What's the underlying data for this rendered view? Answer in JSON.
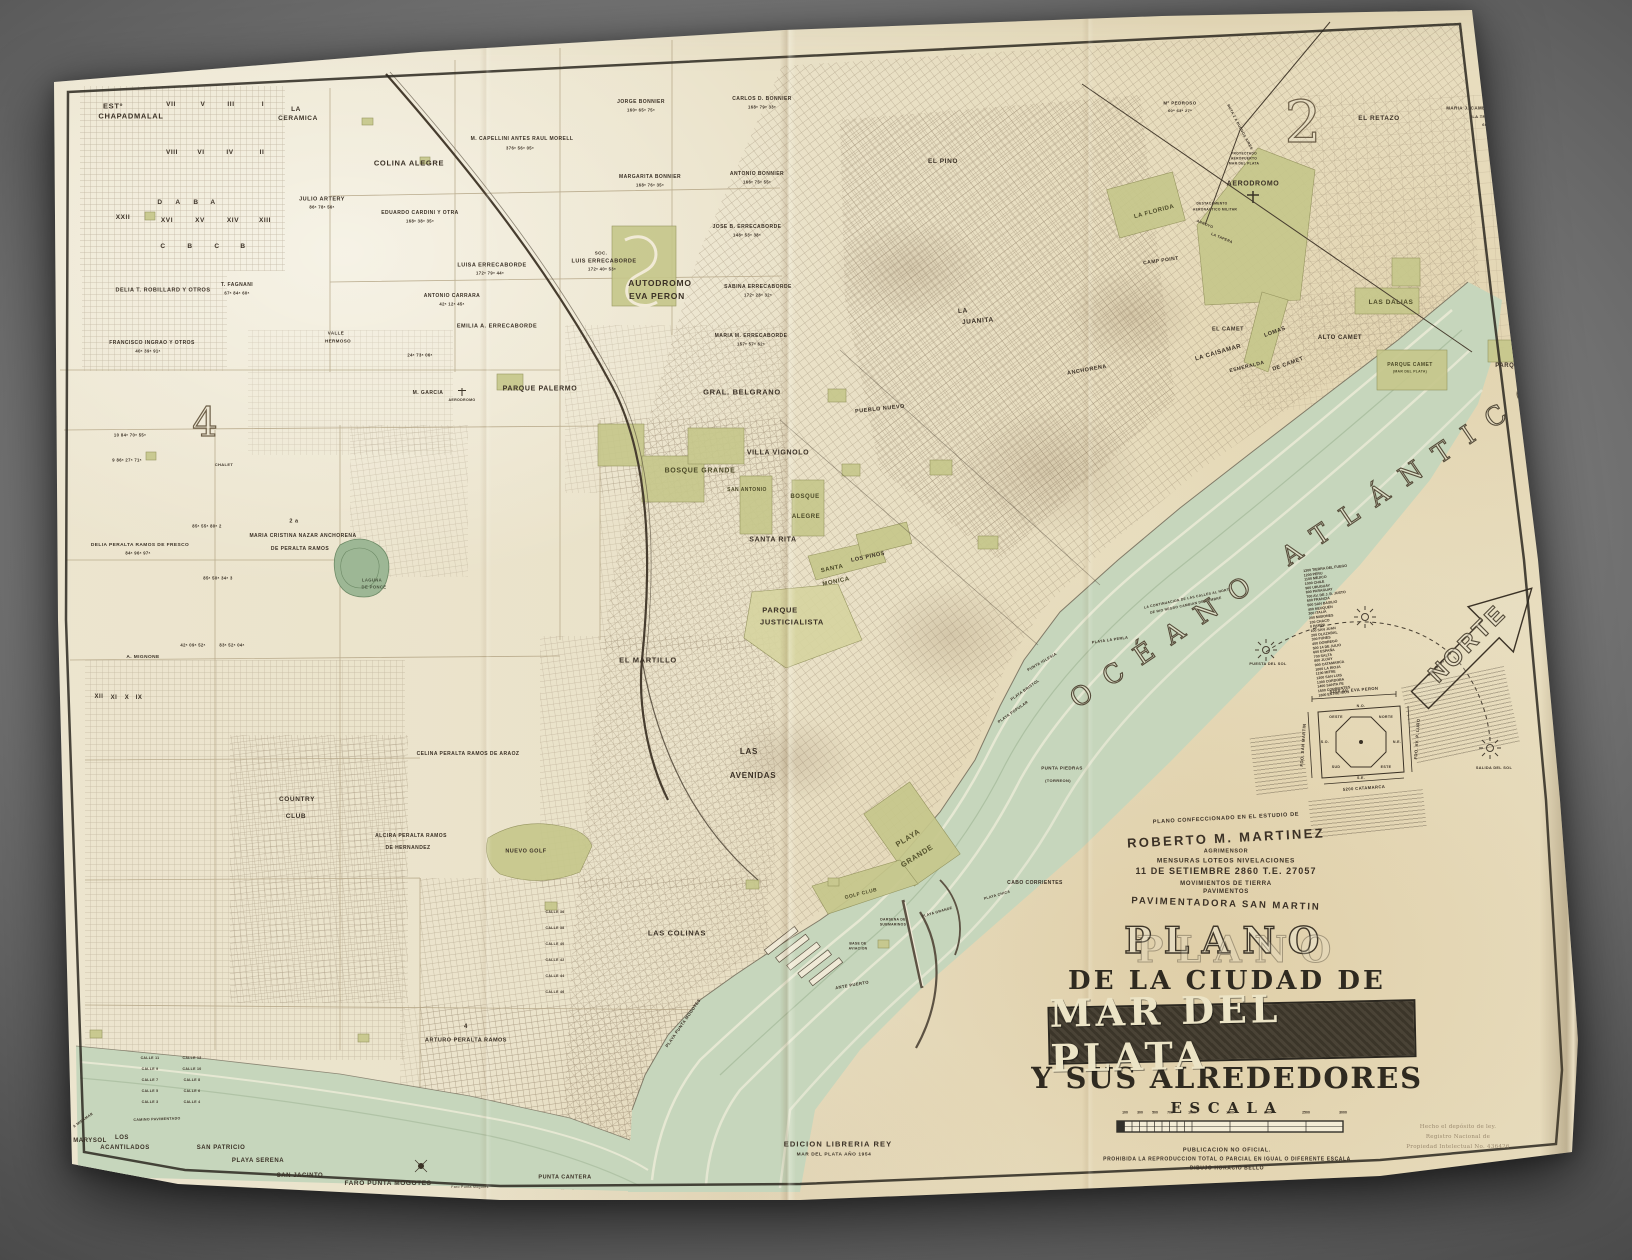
{
  "ocean": {
    "label": "OCÉANO ATLÁNTICO"
  },
  "north": {
    "label": "NORTE"
  },
  "title_block": {
    "attribution": [
      "PLANO CONFECCIONADO EN EL ESTUDIO DE",
      "ROBERTO M. MARTINEZ",
      "AGRIMENSOR",
      "MENSURAS LOTEOS NIVELACIONES",
      "11 DE SETIEMBRE 2860   T.E. 27057",
      "MOVIMIENTOS DE TIERRA",
      "PAVIMENTOS",
      "PAVIMENTADORA  SAN MARTIN"
    ],
    "title_word": "PLANO",
    "subtitle": "DE LA CIUDAD DE",
    "city": "MAR DEL PLATA",
    "subtitle2": "Y SUS ALREDEDORES",
    "scale_label": "ESCALA",
    "publication": [
      "PUBLICACION NO OFICIAL.",
      "PROHIBIDA LA REPRODUCCION TOTAL O PARCIAL EN IGUAL O DIFERENTE ESCALA",
      "DIBUJO HORACIO BELLO"
    ],
    "edition": [
      "EDICION LIBRERIA REY",
      "MAR DEL PLATA AÑO 1954"
    ],
    "deposit": [
      "Hecho el depósito de ley.",
      "Registro Nacional de",
      "Propiedad Intelectual No. 436426"
    ]
  },
  "compass": {
    "top": "5200 AV. EVA PERON",
    "bottom": "5200 CATAMARCA",
    "left": "FDO. SAN MARTIN",
    "right": "FDO. AV. P. LURO",
    "dirs": [
      "NORTE",
      "N.E.",
      "ESTE",
      "S.E.",
      "SUD",
      "S.O.",
      "OESTE",
      "N.O."
    ],
    "meridian": "MERID. 58"
  },
  "scale_ticks": [
    {
      "t": "100",
      "dx": 8
    },
    {
      "t": "300",
      "dx": 23
    },
    {
      "t": "500",
      "dx": 38
    },
    {
      "t": "700",
      "dx": 53
    },
    {
      "t": "1000",
      "dx": 75
    },
    {
      "t": "1500",
      "dx": 113
    },
    {
      "t": "2000",
      "dx": 151
    },
    {
      "t": "2500",
      "dx": 189
    },
    {
      "t": "3000",
      "dx": 226
    }
  ],
  "street_list": [
    "1300 TIERRA DEL FUEGO",
    "1200 PERU",
    "1100 MEJICO",
    "1000 CHILE",
    "900 URUGUAY",
    "800 PARAGUAY",
    "700 AV. DE J. B. JUSTO",
    "600 FRANCIA",
    "500 SAN BASILIO",
    "400 NEUQUEN",
    "300 ITALIA",
    "200 MISIONES",
    "100 CHACO",
    "0 PAMPA",
    "100 SAN JUAN",
    "200 OLAZABAL",
    "300 FUNES",
    "400 DORREGO",
    "500 14 DE JULIO",
    "600 ESPAÑA",
    "700 SALTA",
    "800 JUJUY",
    "900 CATAMARCA",
    "1000 LA RIOJA",
    "1100 MITRE",
    "1200 SAN LUIS",
    "1300 CORDOBA",
    "1400 SANTA FE",
    "1500 CORRIENTES",
    "1600 ENTRE RIOS"
  ],
  "map_labels": [
    {
      "t": "ESTº",
      "x": 113,
      "y": 106,
      "s": 7.5
    },
    {
      "t": "CHAPADMALAL",
      "x": 131,
      "y": 116,
      "s": 7.5
    },
    {
      "t": "VII",
      "x": 171,
      "y": 105,
      "s": 6.5
    },
    {
      "t": "V",
      "x": 203,
      "y": 105,
      "s": 6.5
    },
    {
      "t": "III",
      "x": 231,
      "y": 105,
      "s": 6.5
    },
    {
      "t": "I",
      "x": 263,
      "y": 105,
      "s": 6.5
    },
    {
      "t": "VIII",
      "x": 172,
      "y": 153,
      "s": 6.5
    },
    {
      "t": "VI",
      "x": 201,
      "y": 153,
      "s": 6.5
    },
    {
      "t": "IV",
      "x": 230,
      "y": 153,
      "s": 6.5
    },
    {
      "t": "II",
      "x": 262,
      "y": 153,
      "s": 6.5
    },
    {
      "t": "D",
      "x": 160,
      "y": 203,
      "s": 6.5
    },
    {
      "t": "A",
      "x": 178,
      "y": 203,
      "s": 6.5
    },
    {
      "t": "B",
      "x": 196,
      "y": 203,
      "s": 6.5
    },
    {
      "t": "A",
      "x": 213,
      "y": 203,
      "s": 6.5
    },
    {
      "t": "XVI",
      "x": 167,
      "y": 221,
      "s": 6.5
    },
    {
      "t": "XV",
      "x": 200,
      "y": 221,
      "s": 6.5
    },
    {
      "t": "XIV",
      "x": 233,
      "y": 221,
      "s": 6.5
    },
    {
      "t": "XIII",
      "x": 265,
      "y": 221,
      "s": 6.5
    },
    {
      "t": "C",
      "x": 163,
      "y": 247,
      "s": 6.5
    },
    {
      "t": "B",
      "x": 190,
      "y": 247,
      "s": 6.5
    },
    {
      "t": "C",
      "x": 217,
      "y": 247,
      "s": 6.5
    },
    {
      "t": "B",
      "x": 243,
      "y": 247,
      "s": 6.5
    },
    {
      "t": "XXII",
      "x": 123,
      "y": 218,
      "s": 6.5
    },
    {
      "t": "LA",
      "x": 296,
      "y": 110,
      "s": 6.5
    },
    {
      "t": "CERAMICA",
      "x": 298,
      "y": 119,
      "s": 6.5
    },
    {
      "t": "COLINA ALEGRE",
      "x": 409,
      "y": 163,
      "s": 7.5
    },
    {
      "t": "JULIO ARTERY",
      "x": 322,
      "y": 199,
      "s": 5.5
    },
    {
      "t": "86ᵃ 78ᵃ 56ᵃ",
      "x": 322,
      "y": 207,
      "s": 4.2
    },
    {
      "t": "M. CAPELLINI  ANTES RAUL MORELL",
      "x": 522,
      "y": 139,
      "s": 5
    },
    {
      "t": "376ᵃ 56ᵃ 05ᵃ",
      "x": 520,
      "y": 148,
      "s": 4.2
    },
    {
      "t": "JORGE BONNIER",
      "x": 641,
      "y": 102,
      "s": 5
    },
    {
      "t": "160ᵃ 65ᵃ 75ᵃ",
      "x": 641,
      "y": 110,
      "s": 4.2
    },
    {
      "t": "CARLOS D. BONNIER",
      "x": 762,
      "y": 99,
      "s": 5
    },
    {
      "t": "168ᵃ 79ᵃ 33ᵃ",
      "x": 762,
      "y": 107,
      "s": 4.2
    },
    {
      "t": "MARGARITA BONNIER",
      "x": 650,
      "y": 177,
      "s": 5
    },
    {
      "t": "168ᵃ 76ᵃ 35ᵃ",
      "x": 650,
      "y": 185,
      "s": 4.2
    },
    {
      "t": "ANTONIO BONNIER",
      "x": 757,
      "y": 174,
      "s": 5
    },
    {
      "t": "166ᵃ 75ᵃ 55ᵃ",
      "x": 757,
      "y": 182,
      "s": 4.2
    },
    {
      "t": "DELIA T. ROBILLARD Y OTROS",
      "x": 163,
      "y": 290,
      "s": 5.5
    },
    {
      "t": "T. FAGNANI",
      "x": 237,
      "y": 285,
      "s": 5
    },
    {
      "t": "67ᵃ 84ᵃ 60ᵃ",
      "x": 237,
      "y": 293,
      "s": 4.2
    },
    {
      "t": "FRANCISCO INGRAO Y OTROS",
      "x": 152,
      "y": 343,
      "s": 5
    },
    {
      "t": "40ᵃ 39ᵃ 91ᵃ",
      "x": 148,
      "y": 351,
      "s": 4.2
    },
    {
      "t": "EDUARDO CARDINI Y OTRA",
      "x": 420,
      "y": 213,
      "s": 5
    },
    {
      "t": "168ᵃ 38ᵃ 35ᵃ",
      "x": 420,
      "y": 221,
      "s": 4.2
    },
    {
      "t": "ANTONIO CARRARA",
      "x": 452,
      "y": 296,
      "s": 5
    },
    {
      "t": "42ᵃ 12ᵃ 45ᵃ",
      "x": 452,
      "y": 304,
      "s": 4.2
    },
    {
      "t": "LUISA ERRECABORDE",
      "x": 492,
      "y": 265,
      "s": 5.5
    },
    {
      "t": "172ᵃ 79ᵃ 44ᵃ",
      "x": 490,
      "y": 273,
      "s": 4.2
    },
    {
      "t": "SOC.",
      "x": 601,
      "y": 253,
      "s": 4.5
    },
    {
      "t": "LUIS ERRECABORDE",
      "x": 604,
      "y": 261,
      "s": 5.5
    },
    {
      "t": "172ᵃ 40ᵃ 53ᵃ",
      "x": 602,
      "y": 269,
      "s": 4.2
    },
    {
      "t": "JOSE B. ERRECABORDE",
      "x": 747,
      "y": 227,
      "s": 5
    },
    {
      "t": "148ᵃ 53ᵃ 38ᵃ",
      "x": 747,
      "y": 235,
      "s": 4.2
    },
    {
      "t": "SABINA ERRECABORDE",
      "x": 758,
      "y": 287,
      "s": 5
    },
    {
      "t": "172ᵃ 28ᵃ 32ᵃ",
      "x": 758,
      "y": 295,
      "s": 4.2
    },
    {
      "t": "MARIA M. ERRECABORDE",
      "x": 751,
      "y": 336,
      "s": 5
    },
    {
      "t": "157ᵃ 57ᵃ 62ᵃ",
      "x": 751,
      "y": 344,
      "s": 4.2
    },
    {
      "t": "EMILIA A. ERRECABORDE",
      "x": 497,
      "y": 326,
      "s": 5.5
    },
    {
      "t": "AUTODROMO",
      "x": 660,
      "y": 283,
      "s": 8.5
    },
    {
      "t": "EVA PERON",
      "x": 657,
      "y": 296,
      "s": 8.5
    },
    {
      "t": "PARQUE PALERMO",
      "x": 540,
      "y": 389,
      "s": 7
    },
    {
      "t": "M. GARCIA",
      "x": 428,
      "y": 393,
      "s": 5
    },
    {
      "t": "AERODROMO",
      "x": 462,
      "y": 400,
      "s": 3.6
    },
    {
      "t": "VALLE",
      "x": 336,
      "y": 333,
      "s": 4.5
    },
    {
      "t": "HERMOSO",
      "x": 338,
      "y": 341,
      "s": 4.5
    },
    {
      "t": "24ᵃ 73ᵃ 06ᵃ",
      "x": 420,
      "y": 355,
      "s": 4.2
    },
    {
      "t": "GRAL. BELGRANO",
      "x": 742,
      "y": 392,
      "s": 7.5
    },
    {
      "t": "PUEBLO NUEVO",
      "x": 880,
      "y": 409,
      "s": 5.5,
      "r": -6
    },
    {
      "t": "4",
      "x": 205,
      "y": 423,
      "s": 40,
      "cls": "num"
    },
    {
      "t": "CHALET",
      "x": 224,
      "y": 465,
      "s": 4
    },
    {
      "t": "10  84ᵃ 70ᵃ 55ᵃ",
      "x": 130,
      "y": 435,
      "s": 4.2
    },
    {
      "t": "9  86ᵃ 27ᵃ 71ᵃ",
      "x": 127,
      "y": 460,
      "s": 4.2
    },
    {
      "t": "MARIA CRISTINA NAZAR ANCHORENA",
      "x": 303,
      "y": 536,
      "s": 5
    },
    {
      "t": "DE PERALTA RAMOS",
      "x": 300,
      "y": 549,
      "s": 5
    },
    {
      "t": "2 a",
      "x": 294,
      "y": 521,
      "s": 5.5
    },
    {
      "t": "85ᵃ 55ᵃ 80ᵃ  2",
      "x": 207,
      "y": 526,
      "s": 4.2
    },
    {
      "t": "85ᵃ 50ᵃ 34ᵃ  3",
      "x": 218,
      "y": 578,
      "s": 4.2
    },
    {
      "t": "DELIA PERALTA RAMOS DE FRESCO",
      "x": 140,
      "y": 545,
      "s": 4.8
    },
    {
      "t": "84ᵃ 96ᵃ 97ᵃ",
      "x": 138,
      "y": 553,
      "s": 4.2
    },
    {
      "t": "42ᵃ 09ᵃ 52ᵃ",
      "x": 193,
      "y": 645,
      "s": 4.2
    },
    {
      "t": "83ᵃ 52ᵃ 04ᵃ",
      "x": 232,
      "y": 645,
      "s": 4.2
    },
    {
      "t": "LAGUNA",
      "x": 372,
      "y": 580,
      "s": 4.2,
      "c": "#47523d"
    },
    {
      "t": "DE PONCE",
      "x": 374,
      "y": 587,
      "s": 4.2,
      "c": "#47523d"
    },
    {
      "t": "A. MIGNONE",
      "x": 143,
      "y": 657,
      "s": 4.8
    },
    {
      "t": "XII",
      "x": 99,
      "y": 696,
      "s": 6
    },
    {
      "t": "XI",
      "x": 114,
      "y": 697,
      "s": 6
    },
    {
      "t": "X",
      "x": 127,
      "y": 697,
      "s": 6
    },
    {
      "t": "IX",
      "x": 139,
      "y": 697,
      "s": 6
    },
    {
      "t": "CELINA PERALTA RAMOS DE ARAOZ",
      "x": 468,
      "y": 754,
      "s": 5
    },
    {
      "t": "COUNTRY",
      "x": 297,
      "y": 800,
      "s": 6.5
    },
    {
      "t": "CLUB",
      "x": 296,
      "y": 817,
      "s": 6.5
    },
    {
      "t": "ALCIRA PERALTA RAMOS",
      "x": 411,
      "y": 836,
      "s": 5
    },
    {
      "t": "DE HERNANDEZ",
      "x": 408,
      "y": 848,
      "s": 5
    },
    {
      "t": "NUEVO GOLF",
      "x": 526,
      "y": 851,
      "s": 5.5
    },
    {
      "t": "4",
      "x": 466,
      "y": 1026,
      "s": 6
    },
    {
      "t": "ARTURO PERALTA RAMOS",
      "x": 466,
      "y": 1040,
      "s": 5.5
    },
    {
      "t": "MARYSOL",
      "x": 90,
      "y": 1140,
      "s": 6
    },
    {
      "t": "LOS",
      "x": 122,
      "y": 1137,
      "s": 6
    },
    {
      "t": "ACANTILADOS",
      "x": 125,
      "y": 1147,
      "s": 6
    },
    {
      "t": "SAN PATRICIO",
      "x": 221,
      "y": 1147,
      "s": 6
    },
    {
      "t": "PLAYA SERENA",
      "x": 258,
      "y": 1160,
      "s": 6
    },
    {
      "t": "SAN JACINTO",
      "x": 300,
      "y": 1175,
      "s": 6
    },
    {
      "t": "FARO PUNTA MOGOTES",
      "x": 388,
      "y": 1184,
      "s": 6.5
    },
    {
      "t": "Faro Punta Mogotes",
      "x": 470,
      "y": 1187,
      "s": 3.5,
      "w": 400
    },
    {
      "t": "PUNTA CANTERA",
      "x": 565,
      "y": 1177,
      "s": 5.5
    },
    {
      "t": "CAMINO PAVIMENTADO",
      "x": 157,
      "y": 1119,
      "s": 3.6,
      "r": -2
    },
    {
      "t": "A MIRAMAR",
      "x": 83,
      "y": 1120,
      "s": 3.6,
      "r": -35
    },
    {
      "t": "CALLE 11",
      "x": 150,
      "y": 1058,
      "s": 3.5
    },
    {
      "t": "CALLE 9",
      "x": 150,
      "y": 1069,
      "s": 3.5
    },
    {
      "t": "CALLE 7",
      "x": 150,
      "y": 1080,
      "s": 3.5
    },
    {
      "t": "CALLE 5",
      "x": 150,
      "y": 1091,
      "s": 3.5
    },
    {
      "t": "CALLE 3",
      "x": 150,
      "y": 1102,
      "s": 3.5
    },
    {
      "t": "CALLE 12",
      "x": 192,
      "y": 1058,
      "s": 3.5
    },
    {
      "t": "CALLE 10",
      "x": 192,
      "y": 1069,
      "s": 3.5
    },
    {
      "t": "CALLE 8",
      "x": 192,
      "y": 1080,
      "s": 3.5
    },
    {
      "t": "CALLE 6",
      "x": 192,
      "y": 1091,
      "s": 3.5
    },
    {
      "t": "CALLE 4",
      "x": 192,
      "y": 1102,
      "s": 3.5
    },
    {
      "t": "CALLE 36",
      "x": 555,
      "y": 912,
      "s": 3.5
    },
    {
      "t": "CALLE 38",
      "x": 555,
      "y": 928,
      "s": 3.5
    },
    {
      "t": "CALLE 40",
      "x": 555,
      "y": 944,
      "s": 3.5
    },
    {
      "t": "CALLE 42",
      "x": 555,
      "y": 960,
      "s": 3.5
    },
    {
      "t": "CALLE 44",
      "x": 555,
      "y": 976,
      "s": 3.5
    },
    {
      "t": "CALLE 46",
      "x": 555,
      "y": 992,
      "s": 3.5
    },
    {
      "t": "VILLA VIGNOLO",
      "x": 778,
      "y": 453,
      "s": 7
    },
    {
      "t": "BOSQUE GRANDE",
      "x": 700,
      "y": 471,
      "s": 7,
      "c": "#4c4a28"
    },
    {
      "t": "SAN ANTONIO",
      "x": 747,
      "y": 490,
      "s": 5,
      "c": "#4c4a28"
    },
    {
      "t": "BOSQUE",
      "x": 805,
      "y": 496,
      "s": 6,
      "c": "#4c4a28"
    },
    {
      "t": "ALEGRE",
      "x": 806,
      "y": 516,
      "s": 6,
      "c": "#4c4a28"
    },
    {
      "t": "SANTA RITA",
      "x": 773,
      "y": 540,
      "s": 7
    },
    {
      "t": "SANTA",
      "x": 832,
      "y": 568,
      "s": 6,
      "r": -12,
      "c": "#4c4a28"
    },
    {
      "t": "MONICA",
      "x": 836,
      "y": 581,
      "s": 6,
      "r": -12,
      "c": "#4c4a28"
    },
    {
      "t": "LOS PINOS",
      "x": 868,
      "y": 557,
      "s": 5.5,
      "r": -12
    },
    {
      "t": "PARQUE",
      "x": 780,
      "y": 610,
      "s": 7.5
    },
    {
      "t": "JUSTICIALISTA",
      "x": 792,
      "y": 622,
      "s": 7.5
    },
    {
      "t": "EL MARTILLO",
      "x": 648,
      "y": 660,
      "s": 7.5
    },
    {
      "t": "LAS",
      "x": 749,
      "y": 752,
      "s": 8
    },
    {
      "t": "AVENIDAS",
      "x": 753,
      "y": 776,
      "s": 8
    },
    {
      "t": "LAS COLINAS",
      "x": 677,
      "y": 933,
      "s": 7.5
    },
    {
      "t": "PLAYA",
      "x": 908,
      "y": 838,
      "s": 7.5,
      "r": -32,
      "c": "#55532e"
    },
    {
      "t": "GRANDE",
      "x": 917,
      "y": 856,
      "s": 7.5,
      "r": -32,
      "c": "#55532e"
    },
    {
      "t": "GOLF CLUB",
      "x": 861,
      "y": 894,
      "s": 5,
      "r": -14,
      "c": "#4c4a28"
    },
    {
      "t": "CABO CORRIENTES",
      "x": 1035,
      "y": 883,
      "s": 5
    },
    {
      "t": "PLAYA CHICA",
      "x": 997,
      "y": 895,
      "s": 3.6,
      "r": -16
    },
    {
      "t": "PLAYA GRANDE",
      "x": 937,
      "y": 912,
      "s": 3.6,
      "r": -16
    },
    {
      "t": "PUNTA PIEDRAS",
      "x": 1062,
      "y": 768,
      "s": 4.5
    },
    {
      "t": "(TORREON)",
      "x": 1058,
      "y": 781,
      "s": 4
    },
    {
      "t": "PLAYA LA PERLA",
      "x": 1110,
      "y": 640,
      "s": 3.8,
      "r": -8
    },
    {
      "t": "PUNTA IGLESIA",
      "x": 1042,
      "y": 662,
      "s": 3.8,
      "r": -30
    },
    {
      "t": "PLAYA BRISTOL",
      "x": 1025,
      "y": 690,
      "s": 3.8,
      "r": -35
    },
    {
      "t": "PLAYA POPULAR",
      "x": 1013,
      "y": 712,
      "s": 3.8,
      "r": -35
    },
    {
      "t": "ANTE PUERTO",
      "x": 852,
      "y": 985,
      "s": 4.2,
      "r": -10
    },
    {
      "t": "DARSENA DE",
      "x": 893,
      "y": 920,
      "s": 3.4
    },
    {
      "t": "SUBMARINOS",
      "x": 893,
      "y": 925,
      "s": 3.4
    },
    {
      "t": "BASE DE",
      "x": 858,
      "y": 944,
      "s": 3.4
    },
    {
      "t": "AVIACION",
      "x": 858,
      "y": 949,
      "s": 3.4
    },
    {
      "t": "PLAYA PUNTA MOGOTES",
      "x": 683,
      "y": 1023,
      "s": 4.2,
      "r": -55
    },
    {
      "t": "EL PINO",
      "x": 943,
      "y": 162,
      "s": 6.5
    },
    {
      "t": "LA",
      "x": 963,
      "y": 312,
      "s": 6.5,
      "r": -5
    },
    {
      "t": "JUANITA",
      "x": 978,
      "y": 322,
      "s": 6.5,
      "r": -5
    },
    {
      "t": "ANCHORENA",
      "x": 1087,
      "y": 370,
      "s": 5.5,
      "r": -10
    },
    {
      "t": "LA  CAISAMAR",
      "x": 1218,
      "y": 352,
      "s": 6,
      "r": -16
    },
    {
      "t": "ESMERALDA",
      "x": 1247,
      "y": 367,
      "s": 5,
      "r": -14
    },
    {
      "t": "EL CAMET",
      "x": 1228,
      "y": 329,
      "s": 5.5
    },
    {
      "t": "LOMAS",
      "x": 1275,
      "y": 332,
      "s": 5.5,
      "r": -20
    },
    {
      "t": "DE CAMET",
      "x": 1288,
      "y": 364,
      "s": 5.5,
      "r": -20
    },
    {
      "t": "ALTO CAMET",
      "x": 1340,
      "y": 337,
      "s": 6
    },
    {
      "t": "LAS DALIAS",
      "x": 1391,
      "y": 303,
      "s": 6.5,
      "c": "#4c4a28"
    },
    {
      "t": "PARQUE CAMET",
      "x": 1410,
      "y": 365,
      "s": 5,
      "c": "#4c4a28"
    },
    {
      "t": "(MAR DEL PLATA)",
      "x": 1410,
      "y": 372,
      "s": 3.4,
      "c": "#4c4a28"
    },
    {
      "t": "PARQUE PEÑA",
      "x": 1520,
      "y": 365,
      "s": 6
    },
    {
      "t": "EL RETAZO",
      "x": 1379,
      "y": 119,
      "s": 6.5
    },
    {
      "t": "MARIA J. CAMET DE BENGOLEA",
      "x": 1487,
      "y": 108,
      "s": 4.5
    },
    {
      "t": "\"LA TRINIDAD\"",
      "x": 1487,
      "y": 117,
      "s": 4
    },
    {
      "t": "600ᵃ",
      "x": 1487,
      "y": 125,
      "s": 4
    },
    {
      "t": "Mº PEDROSO",
      "x": 1180,
      "y": 103,
      "s": 4.5
    },
    {
      "t": "60ᵃ 63ᵃ 27ᵃ",
      "x": 1180,
      "y": 111,
      "s": 4
    },
    {
      "t": "AERODROMO",
      "x": 1253,
      "y": 184,
      "s": 7
    },
    {
      "t": "PROYECTADO",
      "x": 1244,
      "y": 154,
      "s": 3.3
    },
    {
      "t": "AEROPUERTO",
      "x": 1244,
      "y": 159,
      "s": 3.3
    },
    {
      "t": "MAR DEL PLATA",
      "x": 1244,
      "y": 164,
      "s": 3.3
    },
    {
      "t": "DESTACAMENTO",
      "x": 1212,
      "y": 204,
      "s": 3.3
    },
    {
      "t": "AERONAUTICO MILITAR",
      "x": 1215,
      "y": 210,
      "s": 3.3
    },
    {
      "t": "LA FLORIDA",
      "x": 1154,
      "y": 211,
      "s": 6,
      "r": -15,
      "c": "#4c4a28"
    },
    {
      "t": "CAMP POINT",
      "x": 1161,
      "y": 261,
      "s": 5,
      "r": -8
    },
    {
      "t": "ARROYO",
      "x": 1205,
      "y": 224,
      "s": 3.6,
      "r": 22
    },
    {
      "t": "LA TAPERA",
      "x": 1222,
      "y": 238,
      "s": 3.6,
      "r": 22
    },
    {
      "t": "RUTA 2 A BUENOS AIRES",
      "x": 1240,
      "y": 127,
      "s": 3.6,
      "r": 62
    },
    {
      "t": "2",
      "x": 1303,
      "y": 122,
      "s": 58,
      "cls": "num2"
    },
    {
      "t": "PUESTA DEL SOL",
      "x": 1268,
      "y": 664,
      "s": 3.8
    },
    {
      "t": "SALIDA DEL SOL",
      "x": 1494,
      "y": 768,
      "s": 3.8
    },
    {
      "t": "MERID. 58",
      "x": 1436,
      "y": 668,
      "s": 3.8,
      "r": -45
    },
    {
      "t": "LA CONTINUACION DE LAS CALLES AL NORTE",
      "x": 1188,
      "y": 599,
      "s": 3.4,
      "r": -12
    },
    {
      "t": "DE RIO NEGRO CAMBIAN DE NOMBRE",
      "x": 1186,
      "y": 606,
      "s": 3.4,
      "r": -12
    }
  ]
}
